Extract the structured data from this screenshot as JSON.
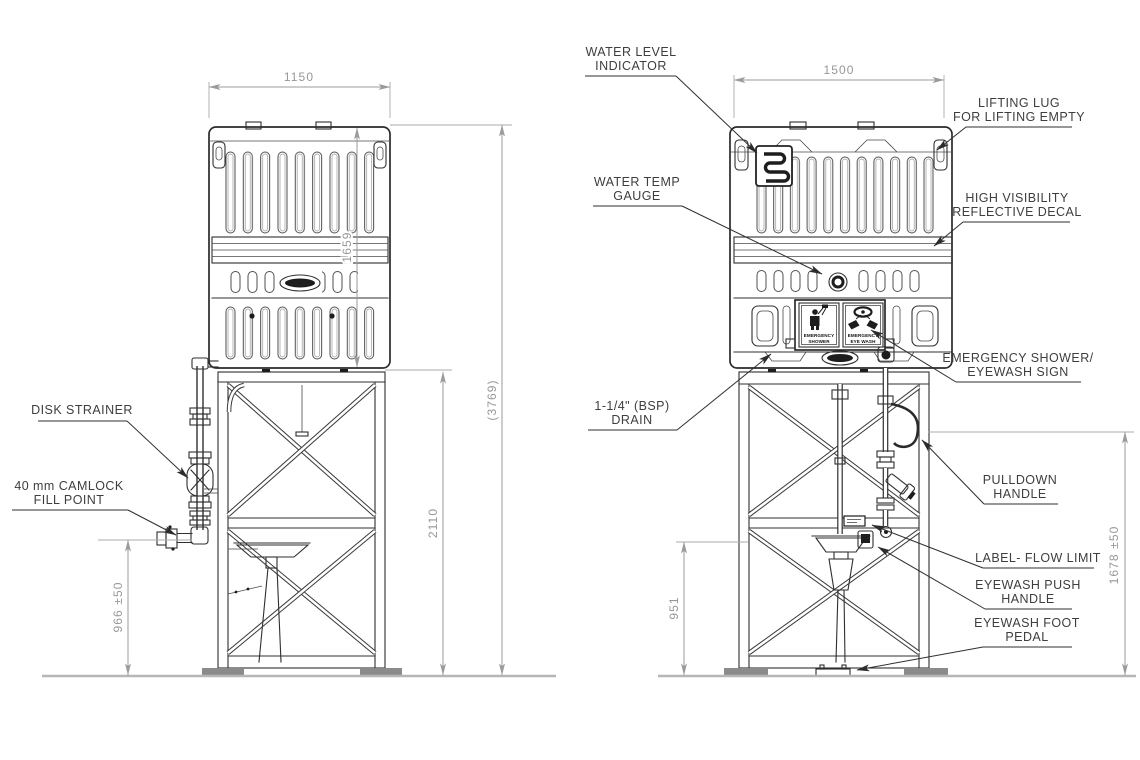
{
  "drawing_type": "technical-orthographic-drawing",
  "colors": {
    "background": "#ffffff",
    "object_line": "#2f2f2f",
    "dimension_line": "#9b9b9b",
    "dimension_text": "#979797",
    "label_text": "#3e3e3e",
    "ground_line": "#b6b6b6",
    "foot_fill": "#8b8b8b"
  },
  "left_view": {
    "dims": {
      "width": "1150",
      "tank_height": "1659",
      "stand_height": "2110",
      "total_height": "(3769)",
      "fill_point_height": "966 ±50"
    },
    "labels": {
      "disk_strainer": "DISK STRAINER",
      "camlock_line1": "40 mm CAMLOCK",
      "camlock_line2": "FILL POINT"
    }
  },
  "right_view": {
    "dims": {
      "width": "1500",
      "bowl_height": "951",
      "handle_height": "1678 ±50"
    },
    "labels": {
      "water_level_line1": "WATER LEVEL",
      "water_level_line2": "INDICATOR",
      "lifting_lug_line1": "LIFTING LUG",
      "lifting_lug_line2": "FOR LIFTING EMPTY",
      "water_temp_line1": "WATER TEMP",
      "water_temp_line2": "GAUGE",
      "decal_line1": "HIGH VISIBILITY",
      "decal_line2": "REFLECTIVE DECAL",
      "sign_line1": "EMERGENCY SHOWER/",
      "sign_line2": "EYEWASH SIGN",
      "drain_line1": "1-1/4\" (BSP)",
      "drain_line2": "DRAIN",
      "pulldown_line1": "PULLDOWN",
      "pulldown_line2": "HANDLE",
      "flow_limit": "LABEL- FLOW LIMIT",
      "push_line1": "EYEWASH PUSH",
      "push_line2": "HANDLE",
      "pedal_line1": "EYEWASH FOOT",
      "pedal_line2": "PEDAL"
    },
    "sign": {
      "shower_line1": "EMERGENCY",
      "shower_line2": "SHOWER",
      "eyewash_line1": "EMERGENCY",
      "eyewash_line2": "EYE WASH"
    }
  }
}
